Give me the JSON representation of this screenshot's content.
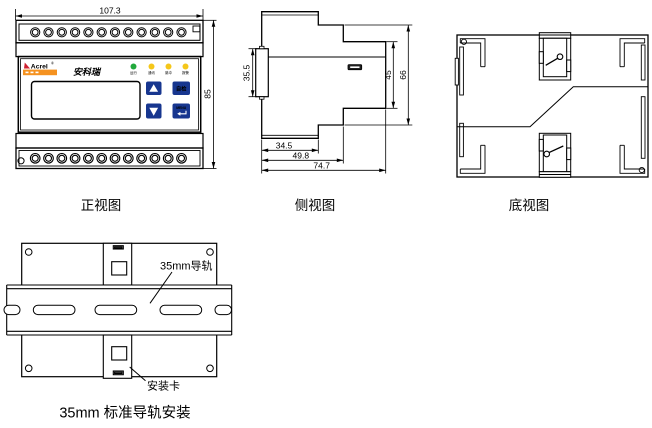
{
  "colors": {
    "line": "#000000",
    "button_blue": "#17368f",
    "logo_red": "#cf2030",
    "logo_orange": "#f59220",
    "brand_blue": "#1d5f9e",
    "led_green": "#22a93c",
    "led_yellow": "#f5c71a"
  },
  "front_view": {
    "caption": "正视图",
    "dims": {
      "width": "107.3",
      "height": "85"
    },
    "logo": {
      "brand": "Acrel",
      "registered": "®",
      "brand_cn": "安科瑞"
    },
    "leds": [
      {
        "label": "运行",
        "color": "#22a93c"
      },
      {
        "label": "通讯",
        "color": "#f5c71a"
      },
      {
        "label": "脉冲",
        "color": "#f5c71a"
      },
      {
        "label": "报警",
        "color": "#f5c71a"
      }
    ],
    "buttons": {
      "self_test": "自检",
      "menu": "MENU"
    }
  },
  "side_view": {
    "caption": "侧视图",
    "dims": {
      "clip_height": "35.5",
      "body_height": "45",
      "overall_height": "66",
      "depth_a": "34.5",
      "depth_b": "49.8",
      "depth_c": "74.7"
    }
  },
  "bottom_view": {
    "caption": "底视图"
  },
  "install_view": {
    "caption": "35mm 标准导轨安装",
    "rail_label": "35mm导轨",
    "clip_label": "安装卡"
  }
}
